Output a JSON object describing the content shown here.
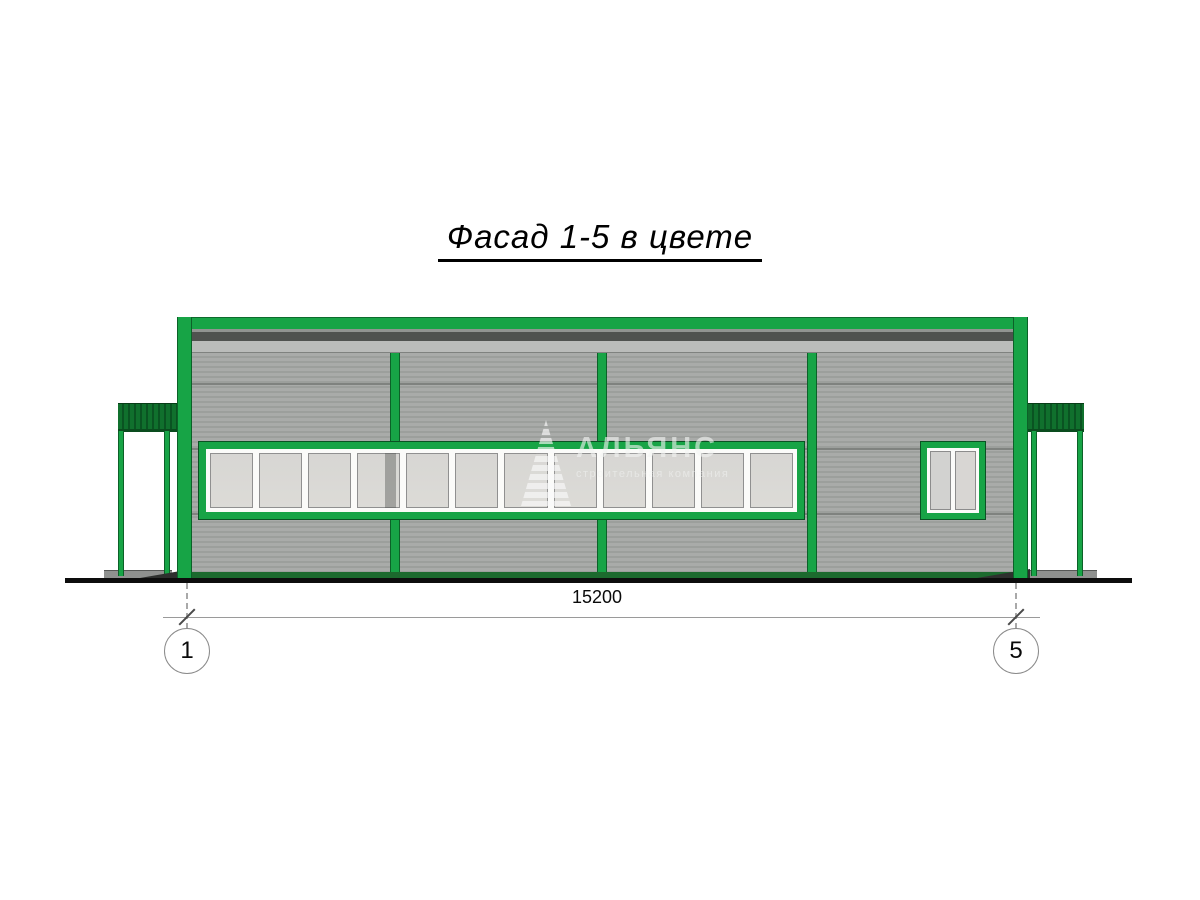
{
  "title": "Фасад 1-5 в цвете",
  "dimension": {
    "value": "15200"
  },
  "axes": [
    {
      "label": "1"
    },
    {
      "label": "5"
    }
  ],
  "watermark": {
    "logo": "striped-triangle-icon",
    "name": "АЛЬЯНС",
    "subtitle": "строительная компания"
  },
  "window_band": {
    "pane_count": 12
  },
  "small_window": {
    "pane_count": 2
  },
  "colors": {
    "accent_green": "#17a446",
    "canopy_green": "#0f6f2c",
    "base_green": "#1c6a2e",
    "roof_dark_gray": "#4f524f",
    "roof_light_gray": "#babcba",
    "wall_gray": "#a8aaa8",
    "ground_black": "#0d0d0d"
  }
}
